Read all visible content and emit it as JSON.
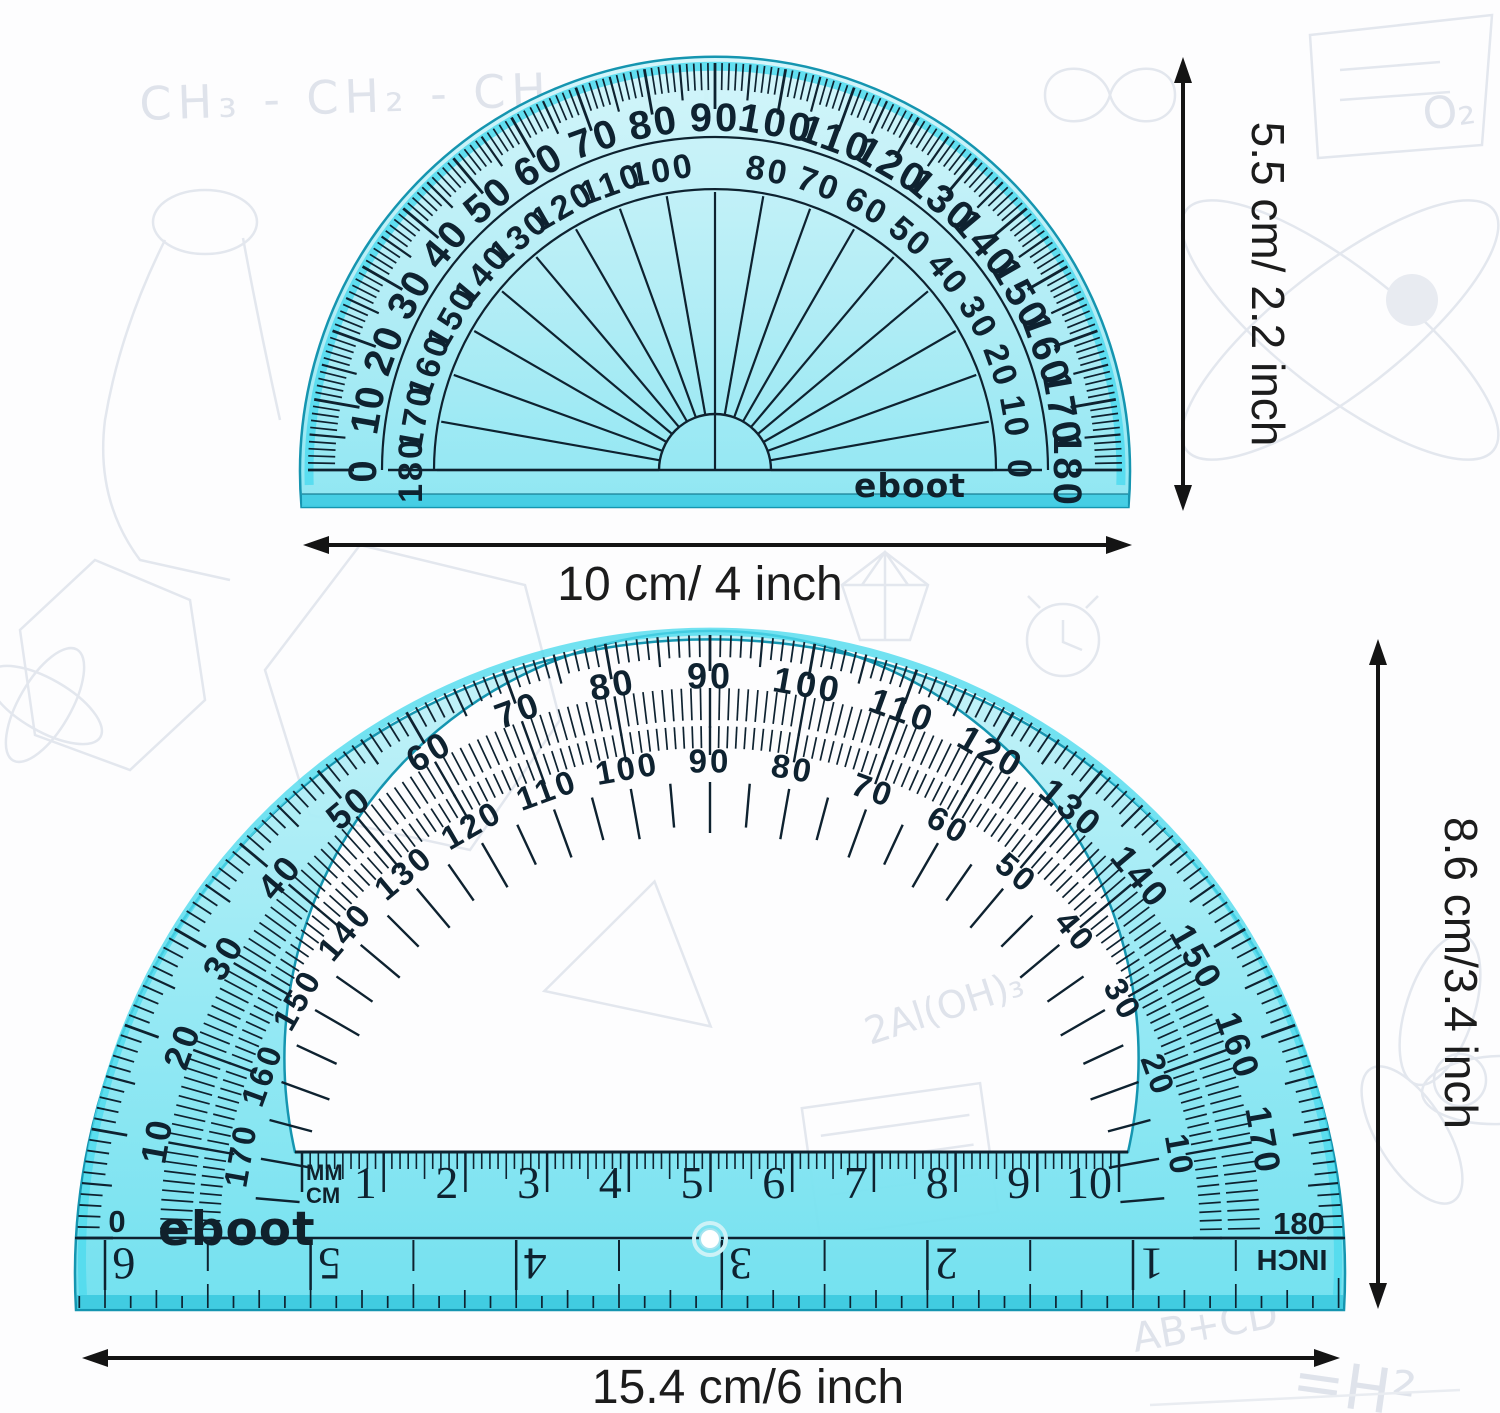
{
  "colors": {
    "small_body_top": "#d2f5fa",
    "small_body_mid": "#aeecf5",
    "small_body_low": "#8ce6f2",
    "large_body_top": "#c6f2f8",
    "large_body_mid": "#95e9f4",
    "large_body_low": "#6fe0ef",
    "edge_highlight": "#4fdbee",
    "edge_stroke": "#1595b0",
    "bevel": "#3ecbe2",
    "ink": "#0e2230",
    "arrow": "#141414",
    "doodle": "#e3e7ee"
  },
  "small_protractor": {
    "brand": "eboot",
    "degree_outer": [
      "0",
      "10",
      "20",
      "30",
      "40",
      "50",
      "60",
      "70",
      "80",
      "90",
      "100",
      "110",
      "120",
      "130",
      "140",
      "150",
      "160",
      "170",
      "180"
    ],
    "degree_inner": [
      "180",
      "170",
      "160",
      "150",
      "140",
      "130",
      "120",
      "110",
      "100",
      null,
      "80",
      "70",
      "60",
      "50",
      "40",
      "30",
      "20",
      "10",
      "0"
    ]
  },
  "large_protractor": {
    "brand": "eboot",
    "degree_outer": [
      "0",
      "10",
      "20",
      "30",
      "40",
      "50",
      "60",
      "70",
      "80",
      "90",
      "100",
      "110",
      "120",
      "130",
      "140",
      "150",
      "160",
      "170",
      "180"
    ],
    "degree_inner": [
      null,
      "170",
      "160",
      "150",
      "140",
      "130",
      "120",
      "110",
      "100",
      "90",
      "80",
      "70",
      "60",
      "50",
      "40",
      "30",
      "20",
      "10",
      null
    ],
    "left_end_label": "0",
    "right_end_label": "180",
    "mm_label": "MM",
    "cm_label": "CM",
    "cm_numbers": [
      "1",
      "2",
      "3",
      "4",
      "5",
      "6",
      "7",
      "8",
      "9",
      "10"
    ],
    "inch_numbers": [
      "6",
      "5",
      "4",
      "3",
      "2",
      "1"
    ],
    "inch_label": "INCH"
  },
  "dimensions": {
    "small_height": "5.5 cm/ 2.2 inch",
    "small_width": "10 cm/ 4 inch",
    "large_height": "8.6 cm/3.4 inch",
    "large_width": "15.4 cm/6 inch"
  },
  "doodles": {
    "formula": "CH₃ - CH₂ - CH₂ - CH",
    "chem2": "2Al(OH)₃",
    "eq_left": "AB+CD",
    "eq_right": "=H²",
    "o2": "O₂"
  }
}
